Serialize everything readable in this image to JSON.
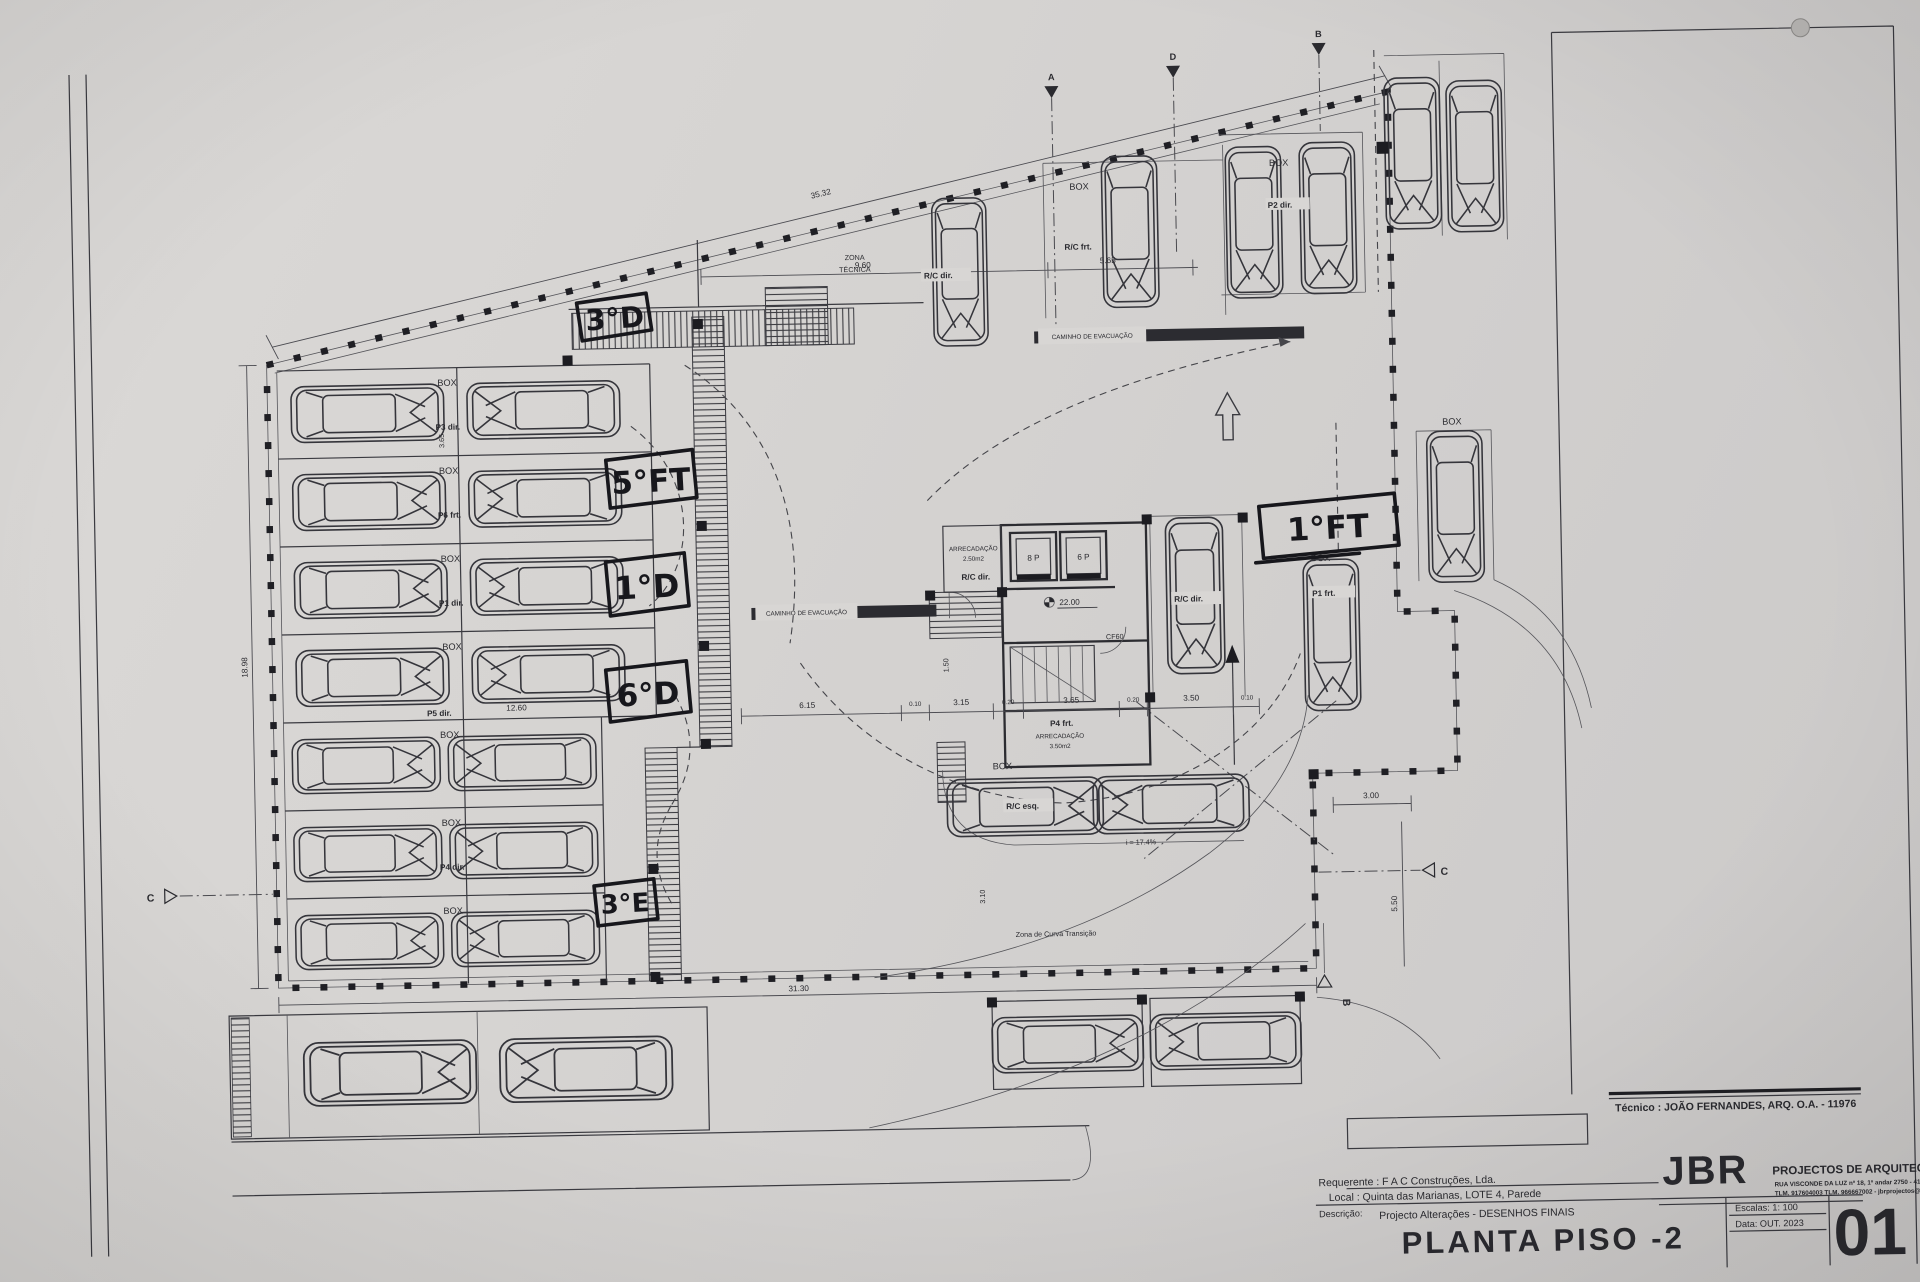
{
  "handwritten": {
    "h1": "3°D",
    "h2": "5°FT",
    "h3": "1°D",
    "h4": "6°D",
    "h5": "3°E",
    "h6": "1°FT"
  },
  "labels": {
    "box": "BOX",
    "zona_line1": "ZONA",
    "zona_line2": "TÉCNICA",
    "caminho": "CAMINHO DE EVACUAÇÃO",
    "rc_dir": "R/C dir.",
    "rc_frt": "R/C frt.",
    "rc_esq": "R/C esq.",
    "p2_dir": "P2 dir.",
    "p1_frt": "P1 frt.",
    "p4_frt": "P4 frt.",
    "arrecadacao": "ARRECADAÇÃO",
    "area_small": "2.50m2",
    "area_big": "3.50m2",
    "lift_a": "8 P",
    "lift_b": "6 P",
    "cf": "CF60",
    "level": "22.00",
    "slope": "i = 17.4%",
    "curve_zone": "Zona de Curva Transição"
  },
  "left_rows": [
    {
      "box": "BOX",
      "p": "P3 dir."
    },
    {
      "box": "BOX",
      "p": "P6 frt."
    },
    {
      "box": "BOX",
      "p": "P1 dir."
    },
    {
      "box": "BOX",
      "p": "P5 dir."
    },
    {
      "box": "BOX",
      "p": ""
    },
    {
      "box": "BOX",
      "p": "P4 dir."
    },
    {
      "box": "BOX",
      "p": ""
    }
  ],
  "dims": {
    "top_slant": "35.32",
    "left_height": "18.98",
    "top_a": "9.60",
    "top_b": "5.65",
    "row_width": "12.60",
    "bottom_width": "31.30",
    "strip": [
      "6.15",
      "0.10",
      "3.15",
      "0.20",
      "3.65",
      "0.20",
      "3.50",
      "0.10"
    ],
    "right_a": "3.00",
    "right_b": "5.50",
    "v_a": "1.50",
    "v_b": "3.10",
    "v_c": "3.65"
  },
  "markers": {
    "top_a": "A",
    "top_d": "D",
    "top_b": "B",
    "left_c": "C",
    "right_c": "C",
    "bottom_b": "B"
  },
  "title_block": {
    "tecnico": "Técnico : JOÃO FERNANDES, ARQ.   O.A. - 11976",
    "firm": "JBR",
    "tagline": "PROJECTOS DE ARQUITECTURA",
    "address": "RUA VISCONDE DA LUZ nº 18, 1º andar  2750 - 416  CASCAIS",
    "contacts": "TLM. 917604003  TLM. 966667002 - jbrprojectos@gmail.com",
    "requerente": "Requerente : F A C  Construções, Lda.",
    "local": "Local : Quinta das Marianas, LOTE 4, Parede",
    "descricao_label": "Descrição:",
    "descricao": "Projecto Alterações - DESENHOS FINAIS",
    "title": "PLANTA PISO -2",
    "escala": "Escalas:  1: 100",
    "data": "Data: OUT.  2023",
    "number": "01"
  }
}
